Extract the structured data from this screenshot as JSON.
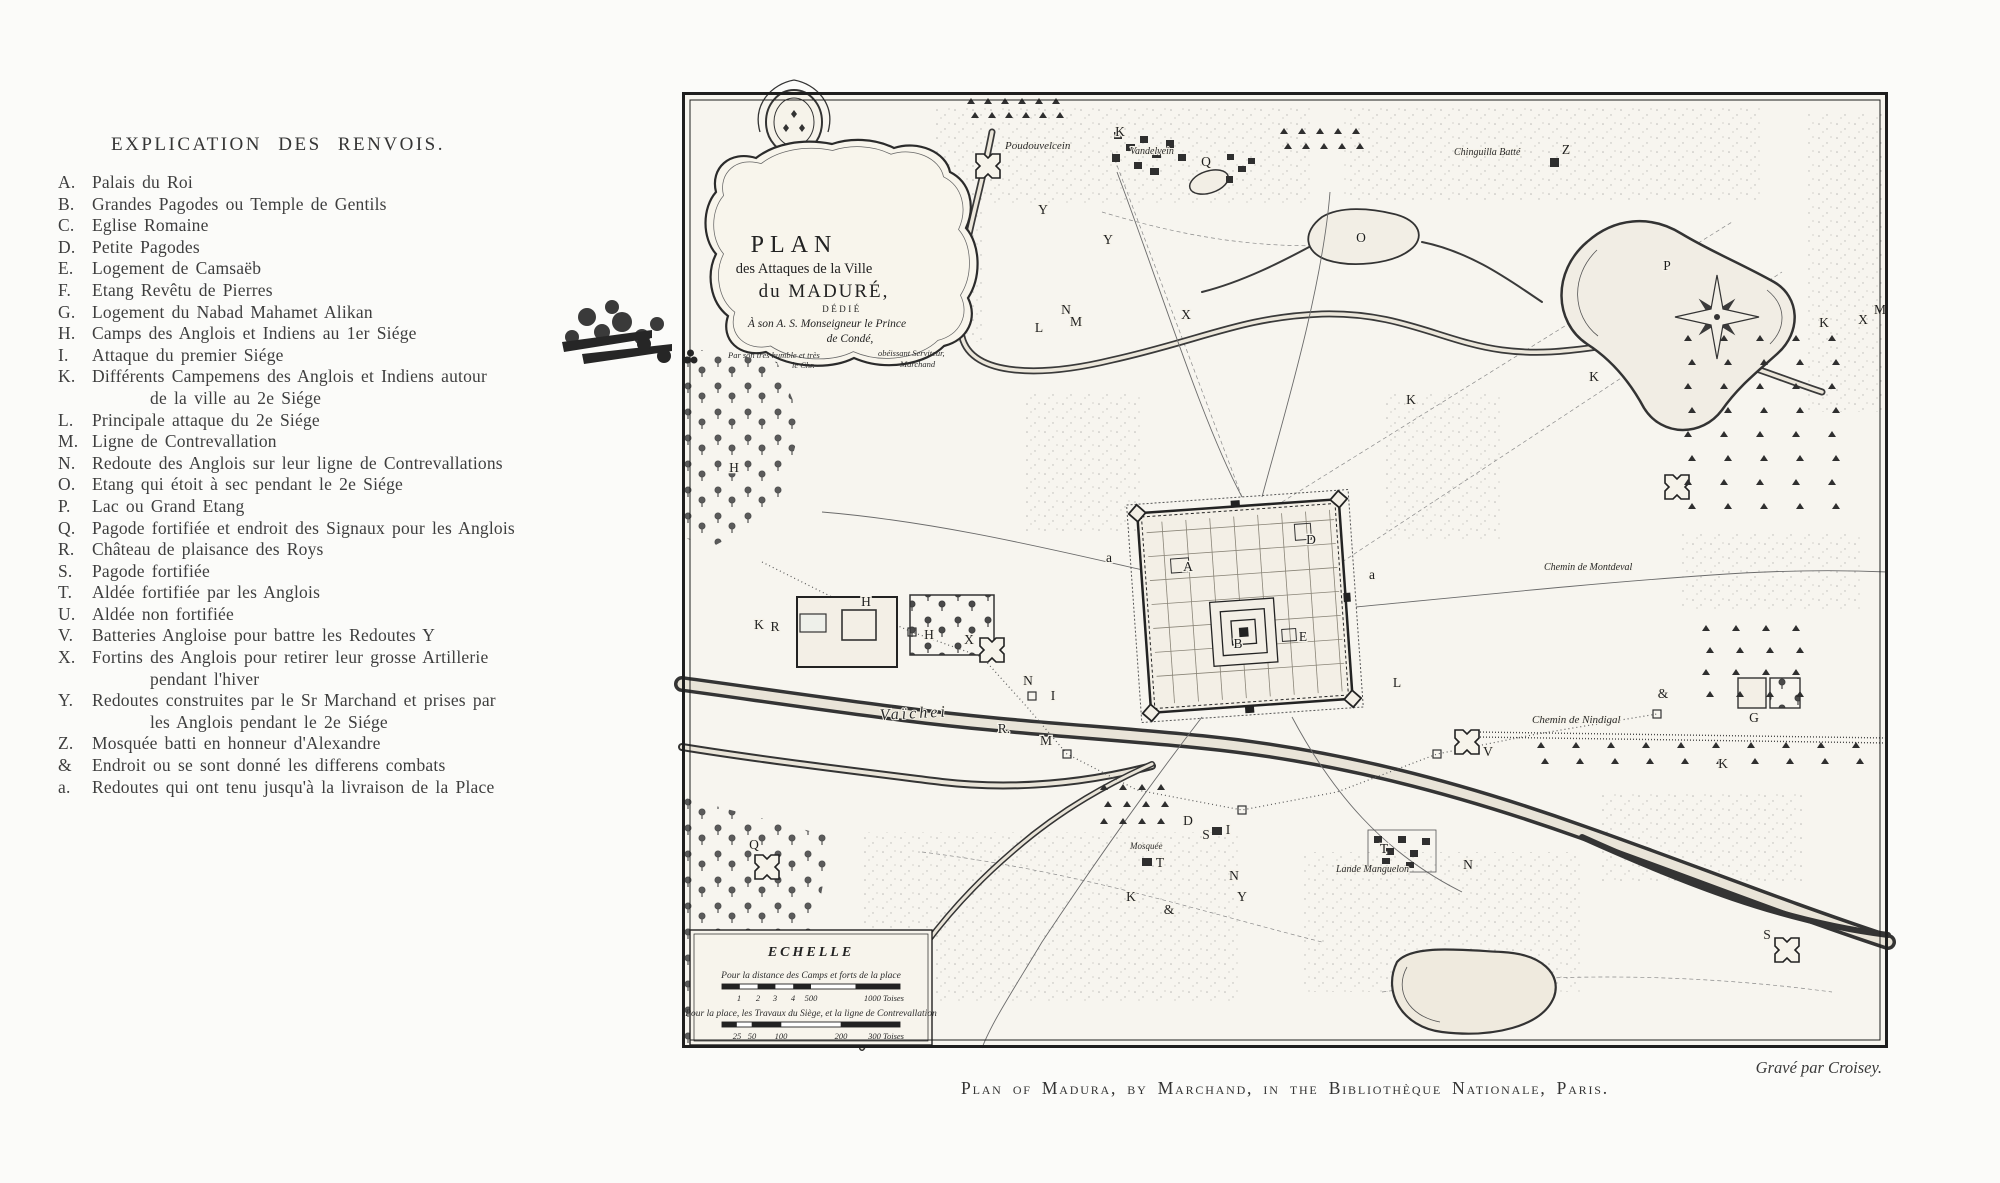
{
  "legend": {
    "title": "EXPLICATION  DES  RENVOIS.",
    "items": [
      {
        "key": "A.",
        "text": "Palais du Roi"
      },
      {
        "key": "B.",
        "text": "Grandes Pagodes ou Temple de Gentils"
      },
      {
        "key": "C.",
        "text": "Eglise Romaine"
      },
      {
        "key": "D.",
        "text": "Petite Pagodes"
      },
      {
        "key": "E.",
        "text": "Logement de Camsaëb"
      },
      {
        "key": "F.",
        "text": "Etang Revêtu de Pierres"
      },
      {
        "key": "G.",
        "text": "Logement du Nabad Mahamet Alikan"
      },
      {
        "key": "H.",
        "text": "Camps des Anglois et Indiens au 1er Siége"
      },
      {
        "key": "I.",
        "text": "Attaque du premier Siége"
      },
      {
        "key": "K.",
        "text": "Différents Campemens des Anglois et Indiens autour",
        "text2": "de la ville au 2e Siége"
      },
      {
        "key": "L.",
        "text": "Principale attaque du 2e Siége"
      },
      {
        "key": "M.",
        "text": "Ligne de Contrevallation"
      },
      {
        "key": "N.",
        "text": "Redoute des Anglois sur leur ligne de Contrevallations"
      },
      {
        "key": "O.",
        "text": "Etang qui étoit à sec pendant le 2e Siége"
      },
      {
        "key": "P.",
        "text": "Lac ou Grand Etang"
      },
      {
        "key": "Q.",
        "text": "Pagode fortifiée et endroit des Signaux pour les Anglois"
      },
      {
        "key": "R.",
        "text": "Château de plaisance des Roys"
      },
      {
        "key": "S.",
        "text": "Pagode fortifiée"
      },
      {
        "key": "T.",
        "text": "Aldée fortifiée par les Anglois"
      },
      {
        "key": "U.",
        "text": "Aldée non fortifiée"
      },
      {
        "key": "V.",
        "text": "Batteries Angloise pour battre les Redoutes Y"
      },
      {
        "key": "X.",
        "text": "Fortins des Anglois pour retirer leur grosse Artillerie",
        "text2": "pendant l'hiver"
      },
      {
        "key": "Y.",
        "text": "Redoutes construites par le Sr Marchand et prises par",
        "text2": "les Anglois pendant le 2e Siége"
      },
      {
        "key": "Z.",
        "text": "Mosquée batti en honneur d'Alexandre"
      },
      {
        "key": "&",
        "text": "Endroit ou se sont donné les differens combats"
      },
      {
        "key": "a.",
        "text": "Redoutes qui ont tenu jusqu'à la livraison de la Place"
      }
    ]
  },
  "map": {
    "cartouche": {
      "title1": "PLAN",
      "title2": "des Attaques de la Ville",
      "title3": "du MADURÉ,",
      "dedication1": "DÉDIÉ",
      "dedication2": "À son A. S. Monseigneur le Prince",
      "dedication3": "de Condé,",
      "byline1": "Par son très humble et très",
      "byline2": "obéissant Serviteur,",
      "byline3": "le Chr.",
      "byline4": "Marchand"
    },
    "scale": {
      "title": "ECHELLE",
      "caption1": "Pour la distance des Camps et forts de la place",
      "bar1_labels": [
        "1",
        "2",
        "3",
        "4",
        "500",
        "1000 Toises"
      ],
      "caption2": "Pour la place, les Travaux du Siège, et la ligne de Contrevallation",
      "bar2_labels": [
        "25",
        "50",
        "100",
        "200",
        "300 Toises"
      ]
    },
    "labels": {
      "river": "Vaïchei",
      "village_top": "Poudouvelcein",
      "village_top2": "Vandelvein",
      "chapel": "Chinguilla Batté",
      "road_right": "Chemin de Montdeval",
      "road_bottom": "Chemin de Nindigal",
      "aldee": "Lande Manguelon",
      "mosque": "Mosquée"
    },
    "letters": [
      {
        "t": "A",
        "x": 506,
        "y": 479
      },
      {
        "t": "B",
        "x": 556,
        "y": 556
      },
      {
        "t": "D",
        "x": 629,
        "y": 452
      },
      {
        "t": "E",
        "x": 621,
        "y": 549
      },
      {
        "t": "a",
        "x": 427,
        "y": 470
      },
      {
        "t": "a",
        "x": 690,
        "y": 487
      },
      {
        "t": "G",
        "x": 1072,
        "y": 630
      },
      {
        "t": "H",
        "x": 52,
        "y": 380
      },
      {
        "t": "H",
        "x": 184,
        "y": 514
      },
      {
        "t": "H",
        "x": 247,
        "y": 547
      },
      {
        "t": "I",
        "x": 371,
        "y": 608
      },
      {
        "t": "I",
        "x": 546,
        "y": 742
      },
      {
        "t": "K",
        "x": 438,
        "y": 44
      },
      {
        "t": "K",
        "x": 1142,
        "y": 235
      },
      {
        "t": "K",
        "x": 912,
        "y": 289
      },
      {
        "t": "K",
        "x": 1041,
        "y": 676
      },
      {
        "t": "K",
        "x": 449,
        "y": 809
      },
      {
        "t": "K",
        "x": 77,
        "y": 537
      },
      {
        "t": "K",
        "x": 729,
        "y": 312
      },
      {
        "t": "L",
        "x": 715,
        "y": 595
      },
      {
        "t": "L",
        "x": 357,
        "y": 240
      },
      {
        "t": "M",
        "x": 364,
        "y": 653
      },
      {
        "t": "M",
        "x": 394,
        "y": 234
      },
      {
        "t": "M",
        "x": 1198,
        "y": 222
      },
      {
        "t": "N",
        "x": 346,
        "y": 593
      },
      {
        "t": "N",
        "x": 552,
        "y": 788
      },
      {
        "t": "N",
        "x": 786,
        "y": 777
      },
      {
        "t": "N",
        "x": 384,
        "y": 222
      },
      {
        "t": "O",
        "x": 679,
        "y": 150
      },
      {
        "t": "P",
        "x": 985,
        "y": 178
      },
      {
        "t": "Q",
        "x": 72,
        "y": 757
      },
      {
        "t": "Q",
        "x": 524,
        "y": 74
      },
      {
        "t": "R",
        "x": 93,
        "y": 539
      },
      {
        "t": "R.",
        "x": 322,
        "y": 641
      },
      {
        "t": "S",
        "x": 1085,
        "y": 847
      },
      {
        "t": "S",
        "x": 524,
        "y": 747
      },
      {
        "t": "T",
        "x": 478,
        "y": 775
      },
      {
        "t": "T",
        "x": 702,
        "y": 761
      },
      {
        "t": "V",
        "x": 806,
        "y": 664
      },
      {
        "t": "X",
        "x": 287,
        "y": 552
      },
      {
        "t": "X",
        "x": 504,
        "y": 227
      },
      {
        "t": "X",
        "x": 1181,
        "y": 232
      },
      {
        "t": "Y",
        "x": 361,
        "y": 122
      },
      {
        "t": "Y",
        "x": 426,
        "y": 152
      },
      {
        "t": "Y",
        "x": 560,
        "y": 809
      },
      {
        "t": "Z",
        "x": 884,
        "y": 62
      },
      {
        "t": "&",
        "x": 981,
        "y": 606
      },
      {
        "t": "&",
        "x": 487,
        "y": 822
      },
      {
        "t": "D",
        "x": 506,
        "y": 733
      }
    ]
  },
  "footer": {
    "credit": "Gravé par Croisey.",
    "caption": "Plan of Madura, by Marchand, in the Bibliothèque Nationale, Paris."
  }
}
